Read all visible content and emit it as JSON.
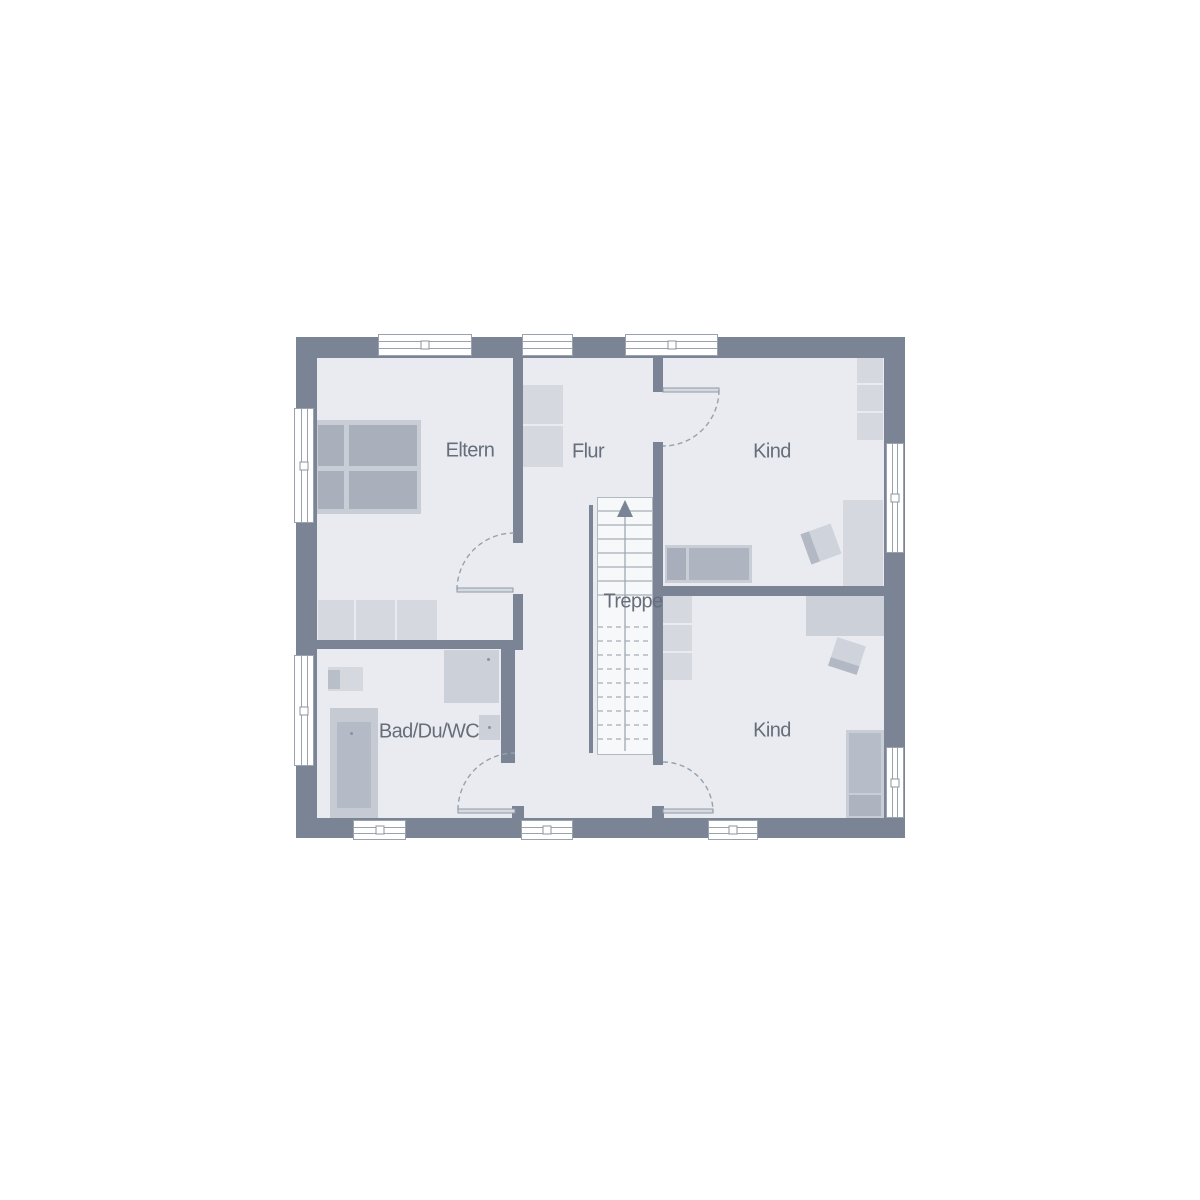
{
  "figure": {
    "type": "floor-plan",
    "style": "architectural top-down plan, upper storey"
  },
  "rooms": [
    {
      "id": "eltern",
      "label": "Eltern"
    },
    {
      "id": "flur",
      "label": "Flur"
    },
    {
      "id": "kind-top",
      "label": "Kind"
    },
    {
      "id": "treppe",
      "label": "Treppe"
    },
    {
      "id": "bad-du-wc",
      "label": "Bad/Du/WC"
    },
    {
      "id": "kind-bottom",
      "label": "Kind"
    }
  ],
  "icons": {
    "stair_direction_arrow": "arrow-up"
  },
  "colors": {
    "background": "#ffffff",
    "wall": "#7a8494",
    "floor": "#e9ebf0",
    "stair_fill": "#f7f8fa",
    "line": "#9aa2ae",
    "furniture_light": "#d5d8df",
    "furniture_medium": "#ccd0d9",
    "bed_gray": "#a9afbb",
    "label_text": "#656e7a"
  }
}
